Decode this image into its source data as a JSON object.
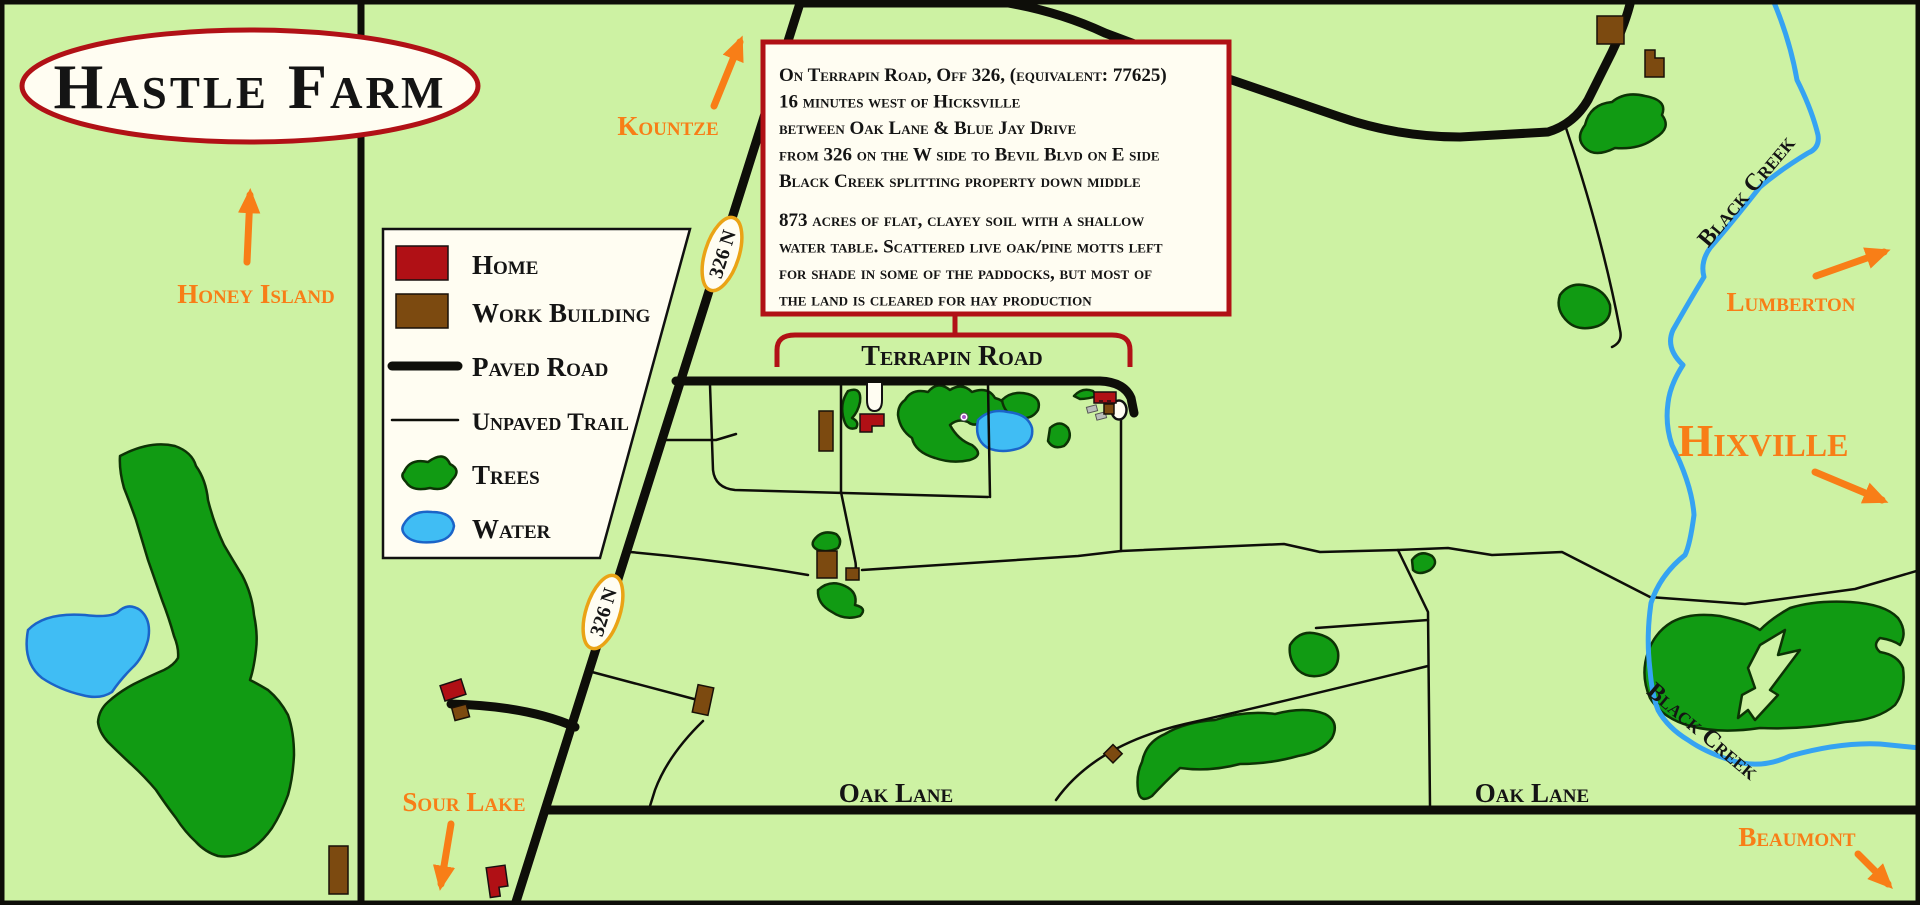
{
  "map_title": "Hastle Farm",
  "info_box": {
    "location_lines": [
      "On Terrapin Road, Off 326, (equivalent: 77625)",
      "16 minutes west of Hicksville",
      "between Oak Lane & Blue Jay Drive",
      "from 326 on the W side to Bevil Blvd on E side",
      "Black Creek splitting property down middle"
    ],
    "description_lines": [
      "873 acres of flat, clayey soil with a shallow",
      "water table. Scattered live oak/pine motts left",
      "for shade in some of the paddocks, but most of",
      "the land is cleared for hay production"
    ]
  },
  "legend": {
    "items": [
      {
        "label": "Home"
      },
      {
        "label": "Work Building"
      },
      {
        "label": "Paved Road"
      },
      {
        "label": "Unpaved Trail"
      },
      {
        "label": "Trees"
      },
      {
        "label": "Water"
      }
    ]
  },
  "roads": {
    "terrapin_road": "Terrapin Road",
    "oak_lane_west": "Oak Lane",
    "oak_lane_east": "Oak Lane",
    "highway_shield": "326 N"
  },
  "waterways": {
    "black_creek_north": "Black Creek",
    "black_creek_south": "Black Creek"
  },
  "places": {
    "honey_island": "Honey Island",
    "kountze": "Kountze",
    "sour_lake": "Sour Lake",
    "lumberton": "Lumberton",
    "hixville": "Hixville",
    "beaumont": "Beaumont"
  },
  "colors": {
    "bg": "#cdf2a3",
    "paper": "#fffdf2",
    "road": "#0e0e09",
    "tree": "#119b13",
    "tree_dark": "#0d3305",
    "water": "#40bdf4",
    "water_dark": "#1b64c8",
    "creek": "#35a3f2",
    "home": "#b01015",
    "work": "#7c4a10",
    "accent": "#b11116",
    "orange": "#f87e17",
    "shield": "#eaa315",
    "gray": "#b9beb9"
  }
}
